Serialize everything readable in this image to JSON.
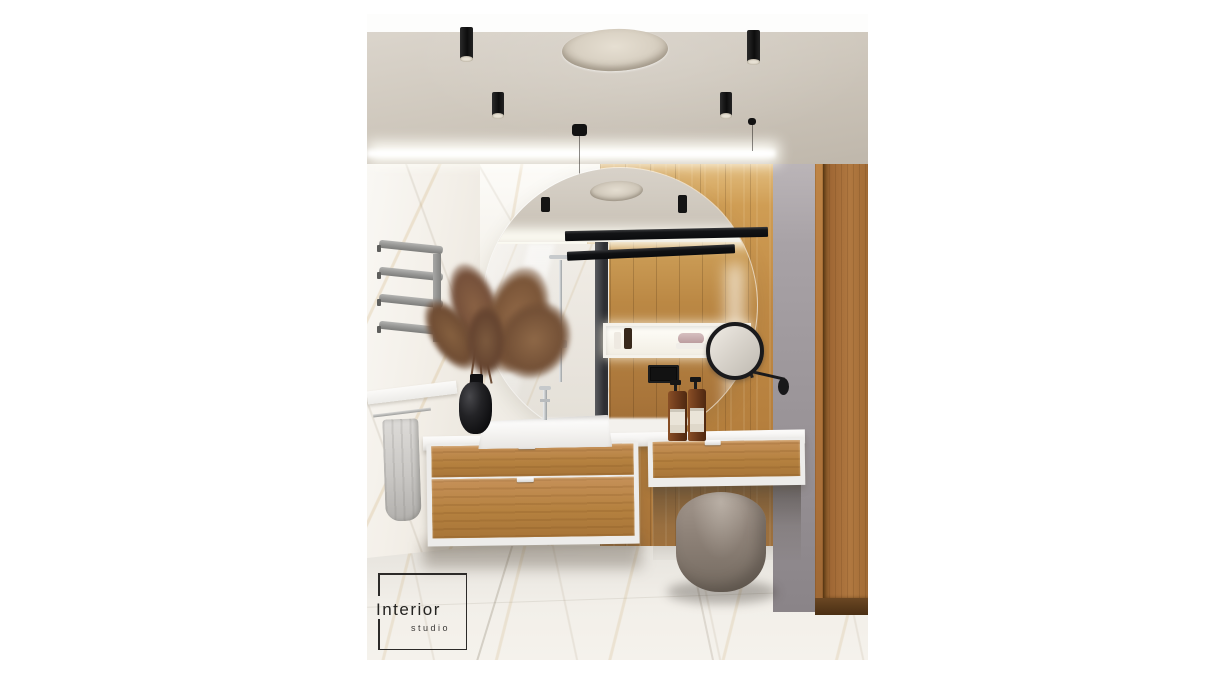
{
  "image": {
    "type": "3d-interior-render",
    "room": "bathroom",
    "style": "modern wood and marble"
  },
  "logo": {
    "line1": "Interior",
    "line2": "studio"
  },
  "palette": {
    "canvas": "#ffffff",
    "ceiling": "#ccc5ba",
    "marble": "#f3f0ea",
    "marble-vein-gold": "#c8a05f",
    "wood-light": "#c99551",
    "wood-mid": "#b5813f",
    "wood-dark": "#96682f",
    "gray-wall": "#a19ba0",
    "fixture-black": "#17181a",
    "chrome": "#c9cccd",
    "counter-white": "#f5f4f2",
    "pouf-taupe": "#8d8177",
    "amber-bottle": "#6f3c1c",
    "towel-gray": "#d2d0cd",
    "floor-marble": "#efece6"
  },
  "scene": {
    "objects": [
      "ceiling spotlight x5",
      "round ceiling lamp",
      "led cove lighting",
      "pendant wire lamp",
      "arched round wall mirror",
      "black linear light bar with reflection",
      "oak plank back wall",
      "white marble tile wall",
      "chrome towel radiator",
      "white wall shelf with towel rail",
      "gray hand towel",
      "pampas grass in black vase",
      "white vessel sink",
      "chrome faucet",
      "floating oak vanity with white frame",
      "dressing table extension",
      "amber soap dispenser x2",
      "backlit niche with toiletries (reflected)",
      "black flush plate (reflected)",
      "round cosmetic mirror on wall arm",
      "gray accent wall",
      "oak door",
      "taupe pouf",
      "marble floor",
      "studio watermark logo"
    ]
  }
}
